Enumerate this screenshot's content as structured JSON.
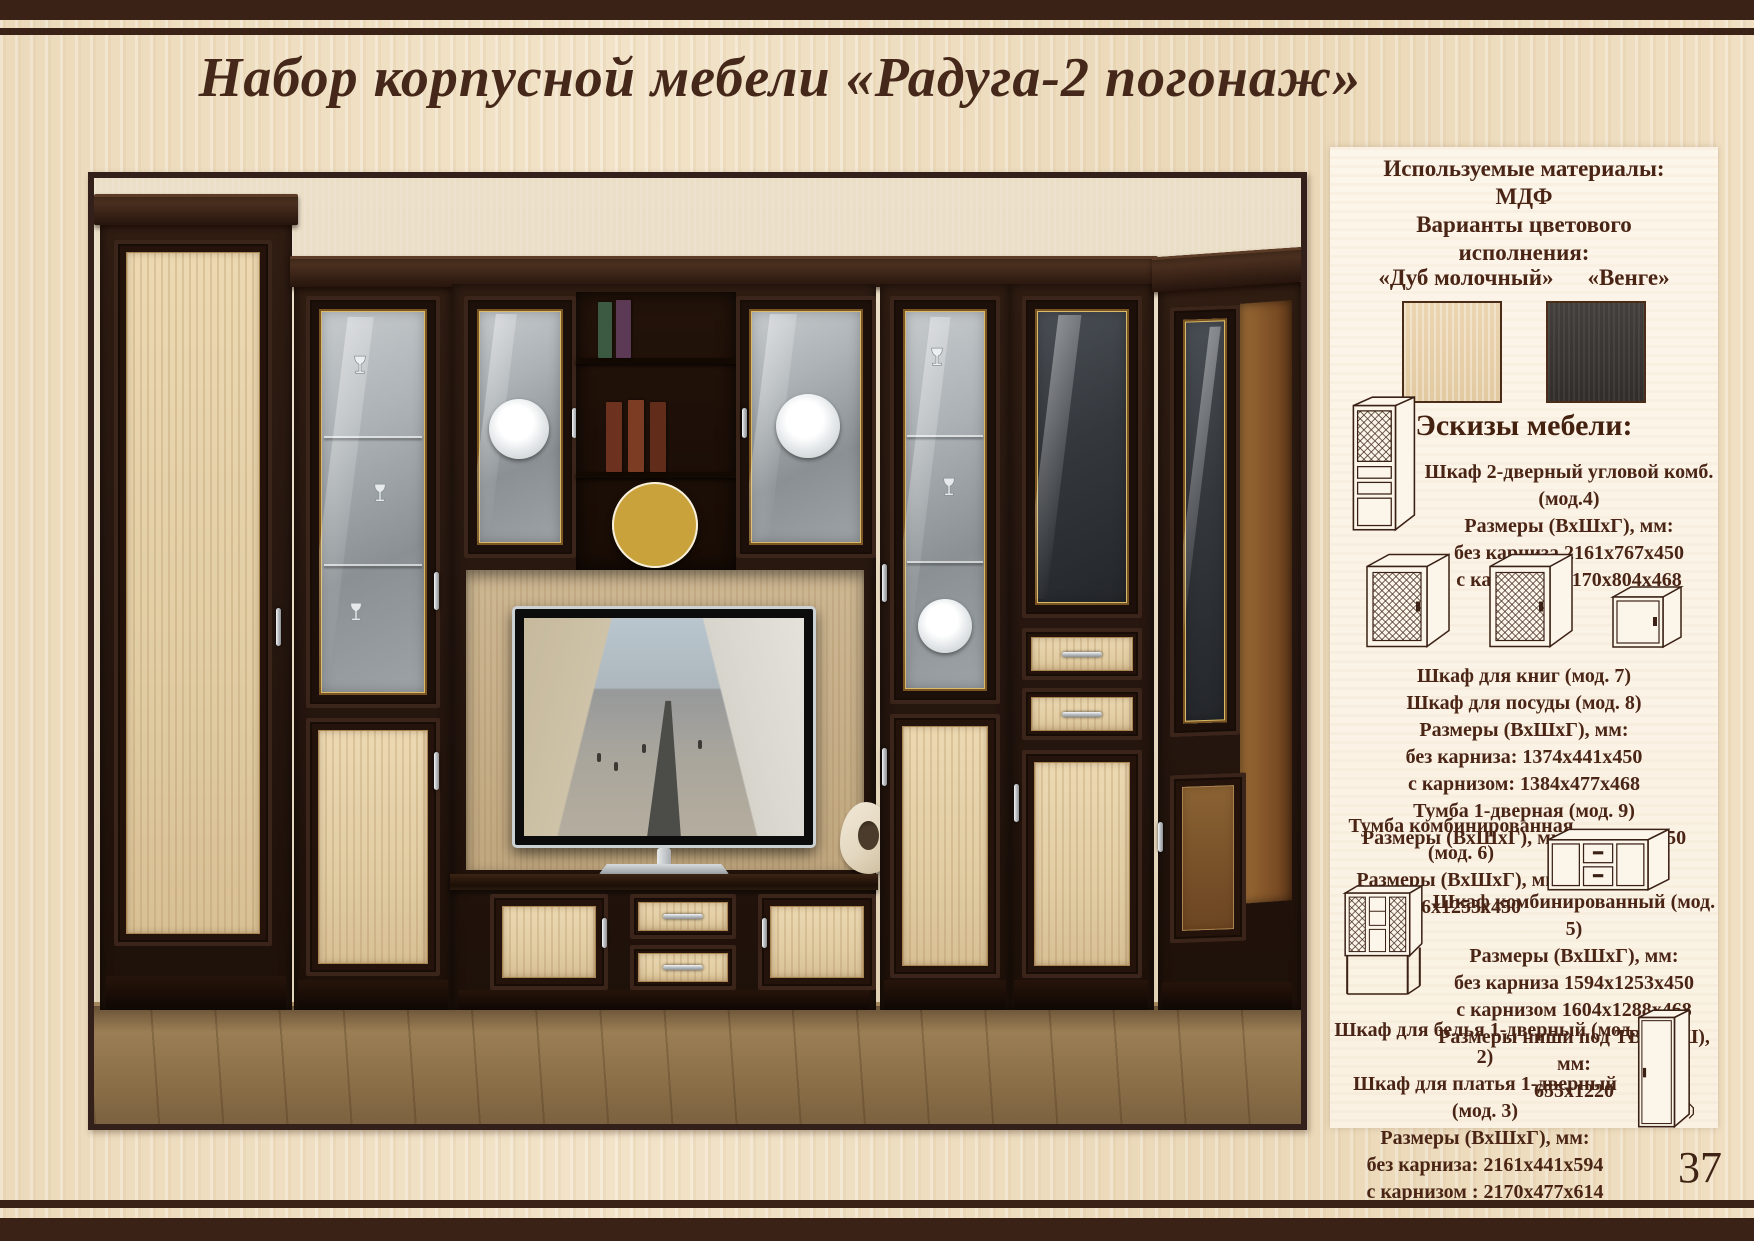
{
  "page": {
    "title": "Набор корпусной мебели  «Радуга-2 погонаж»",
    "page_number": "37"
  },
  "sidebar": {
    "materials": {
      "line1": "Используемые материалы:",
      "line2": "МДФ",
      "line3": "Варианты цветового",
      "line4": "исполнения:",
      "color1_label": "«Дуб молочный»",
      "color2_label": "«Венге»",
      "color1_hex": "#e7d3ae",
      "color2_hex": "#3b3734"
    },
    "sketches_heading": "Эскизы мебели:",
    "blocks": [
      {
        "lines": [
          "Шкаф 2-дверный угловой комб.",
          "(мод.4)",
          "Размеры (ВхШхГ), мм:",
          "без карниза 2161х767х450",
          "с карнизом 2170х804х468"
        ]
      },
      {
        "lines": [
          "Шкаф для книг (мод. 7)",
          "Шкаф для посуды (мод. 8)",
          "Размеры (ВхШхГ), мм:",
          "без карниза: 1374х441х450",
          "с карнизом: 1384х477х468",
          "Тумба 1-дверная (мод. 9)",
          "Размеры (ВхШхГ), мм: 786х441х450"
        ]
      },
      {
        "lines": [
          "Тумба комбинированная",
          "(мод. 6)",
          "Размеры (ВхШхГ), мм:",
          "566х1253х450"
        ]
      },
      {
        "lines": [
          "Шкаф комбинированный (мод. 5)",
          "Размеры (ВхШхГ), мм:",
          "без карниза 1594х1253х450",
          "с карнизом 1604х1288х468",
          "Размеры ниши под ТВ (ВхШ), мм:",
          "655х1220"
        ]
      },
      {
        "lines": [
          "Шкаф для белья 1-дверный (мод. 2)",
          "Шкаф для платья 1-дверный (мод. 3)",
          "Размеры (ВхШхГ), мм:",
          "без карниза: 2161х441х594",
          "с карнизом : 2170х477х614"
        ]
      }
    ]
  }
}
